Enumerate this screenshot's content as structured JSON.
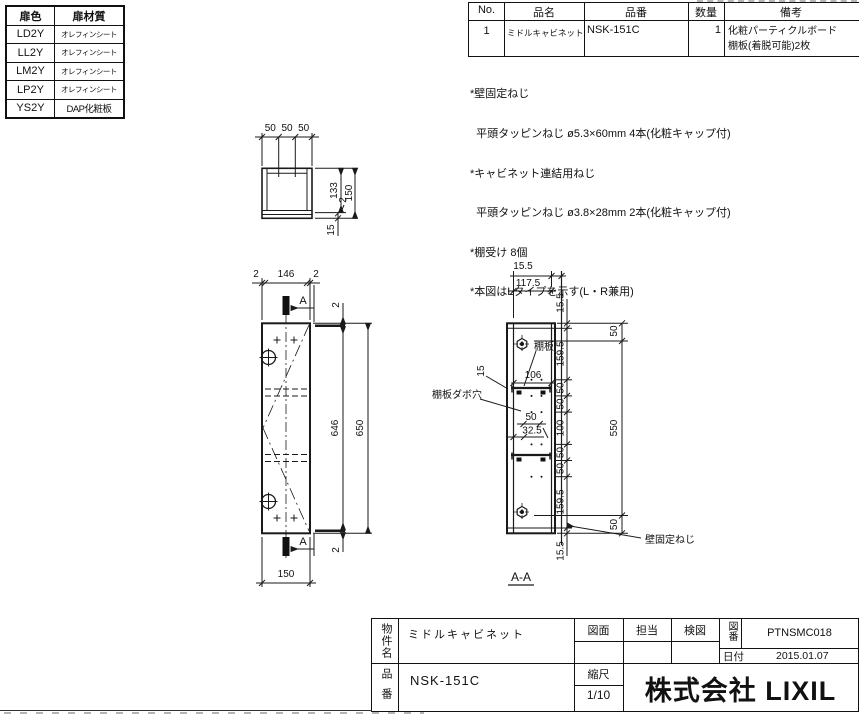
{
  "door_table": {
    "headers": [
      "扉色",
      "扉材質"
    ],
    "rows": [
      [
        "LD2Y",
        "オレフィンシート"
      ],
      [
        "LL2Y",
        "オレフィンシート"
      ],
      [
        "LM2Y",
        "オレフィンシート"
      ],
      [
        "LP2Y",
        "オレフィンシート"
      ],
      [
        "YS2Y",
        "DAP化粧板"
      ]
    ]
  },
  "parts_table": {
    "headers": [
      "No.",
      "品名",
      "品番",
      "数量",
      "備考"
    ],
    "row": {
      "no": "1",
      "name": "ミドルキャビネット",
      "part_no": "NSK-151C",
      "qty": "1",
      "remarks_line1": "化粧パーティクルボード",
      "remarks_line2": "棚板(着脱可能)2枚"
    }
  },
  "notes": [
    "*壁固定ねじ",
    "  平頭タッピンねじ ø5.3×60mm 4本(化粧キャップ付)",
    "*キャビネット連結用ねじ",
    "  平頭タッピンねじ ø3.8×28mm 2本(化粧キャップ付)",
    "*棚受け 8個",
    "*本図はLタイプを示す(L・R兼用)"
  ],
  "plan_view": {
    "top_dims": [
      "50",
      "50",
      "50"
    ],
    "depth_body": "133",
    "depth_total": "150",
    "gap": "2",
    "door": "15"
  },
  "front_view": {
    "edge_left": "2",
    "width_inner": "146",
    "edge_right": "2",
    "section_mark": "A",
    "edge_top": "2",
    "height_inner": "646",
    "height_total": "650",
    "edge_bottom": "2",
    "width_total": "150"
  },
  "section_view": {
    "back_offset": "15.5",
    "depth_body": "117.5",
    "chain": [
      "15.5",
      "159.5",
      "50",
      "50",
      "100",
      "50",
      "50",
      "159.5",
      "15.5"
    ],
    "outer": [
      "50",
      "550",
      "50"
    ],
    "shelf_width": "106",
    "dowel_pitch": "50",
    "dowel_offset": "32.5",
    "door_thickness": "15",
    "shelf_label": "棚板",
    "dowel_label": "棚板ダボ穴",
    "wall_screw_label": "壁固定ねじ",
    "section_title": "A-A"
  },
  "title_block": {
    "project_label": "物件名",
    "project_name": "ミドルキャビネット",
    "drawing_label": "図面",
    "staff_label": "担当",
    "check_label": "検図",
    "drawing_no_label": "図番",
    "drawing_no": "PTNSMC018",
    "date_label": "日付",
    "date": "2015.01.07",
    "part_label": "品番",
    "part_no": "NSK-151C",
    "scale_label": "縮尺",
    "scale": "1/10",
    "company": "株式会社 LIXIL"
  }
}
